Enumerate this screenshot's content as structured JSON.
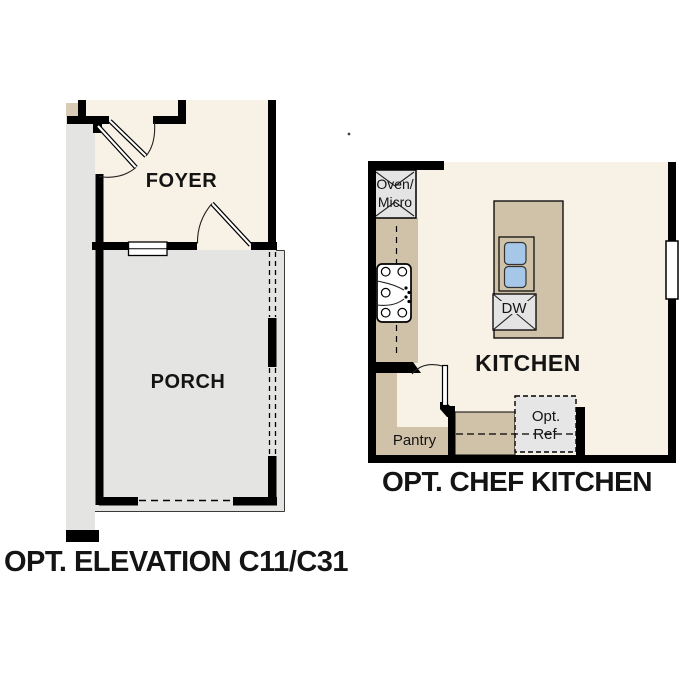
{
  "colors": {
    "background": "#ffffff",
    "wall": "#000000",
    "floor_cream": "#f8f1e5",
    "counter_tan": "#cfc2a8",
    "porch_gray": "#e4e4e2",
    "appliance_gray": "#e4e4e4",
    "opt_ref_gray": "#e6e6e6",
    "sink_blue": "#a7c7e8",
    "beige_accent": "#d8ccb6"
  },
  "elevation_plan": {
    "caption": "OPT. ELEVATION C11/C31",
    "foyer_label": "FOYER",
    "porch_label": "PORCH"
  },
  "chef_kitchen": {
    "caption": "OPT. CHEF KITCHEN",
    "kitchen_label": "KITCHEN",
    "oven_micro_line1": "Oven/",
    "oven_micro_line2": "Micro",
    "dishwasher_label": "DW",
    "pantry_label": "Pantry",
    "opt_ref_line1": "Opt.",
    "opt_ref_line2": "Ref"
  }
}
